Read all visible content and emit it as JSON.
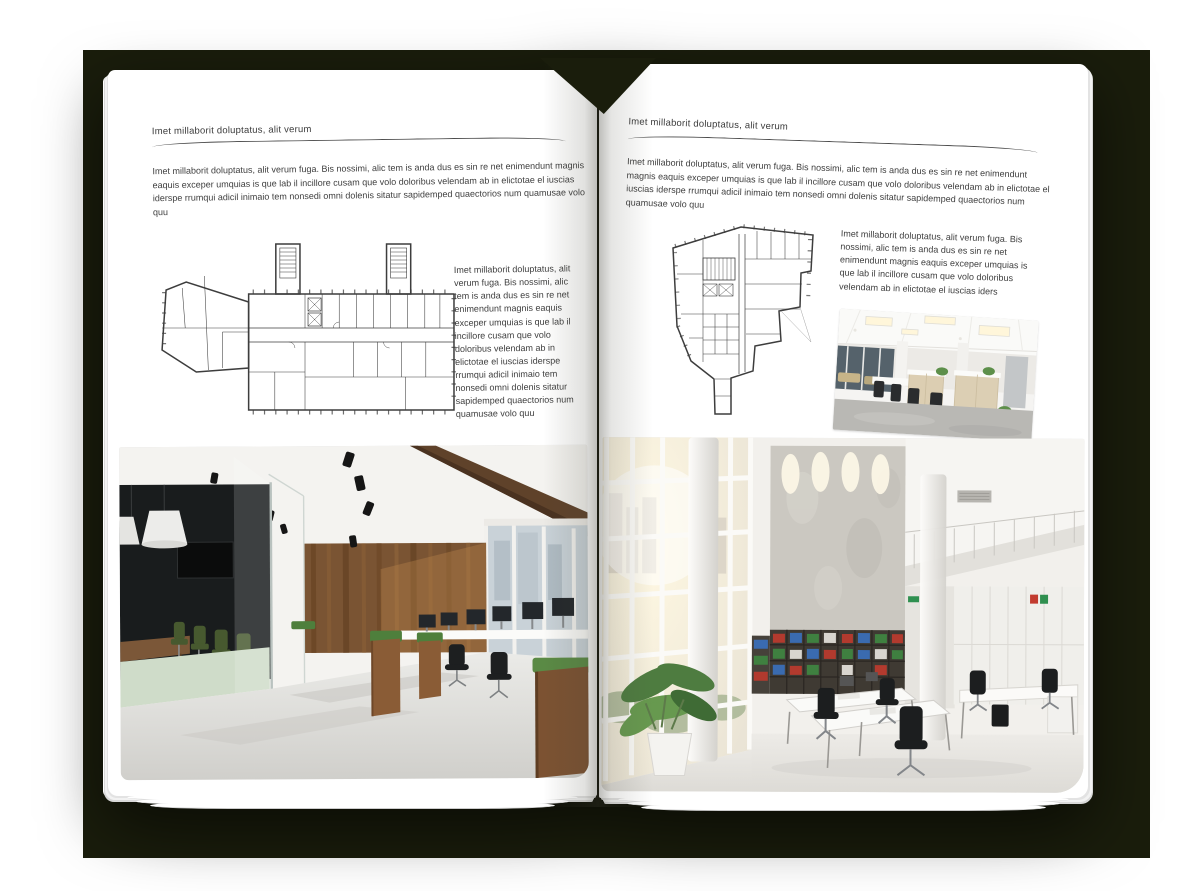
{
  "colors": {
    "backdrop": "#1a1d0c",
    "page": "#ffffff",
    "text": "#3e3e3e",
    "rule": "#4c4c4c",
    "plan_line": "#3d3d3d"
  },
  "left_page": {
    "header": "Imet millaborit doluptatus, alit verum",
    "body": "Imet millaborit doluptatus, alit verum fuga. Bis nossimi, alic tem is anda dus es sin re net enimendunt magnis eaquis exceper umquias is que lab il incillore cusam que volo doloribus velendam ab in elictotae el iuscias iderspe rrumqui adicil inimaio tem nonsedi omni dolenis sitatur sapidemped quaectorios num quamusae volo quu",
    "side_text": "Imet millaborit doluptatus, alit verum fuga. Bis nossimi, alic tem is anda dus es sin re net enimendunt magnis eaquis exceper umquias is que lab il incillore cusam que volo doloribus velendam ab in elictotae el iuscias iderspe rrumqui adicil inimaio tem nonsedi omni dolenis sitatur sapidemped quaectorios num quamusae volo quu"
  },
  "right_page": {
    "header": "Imet millaborit doluptatus, alit verum",
    "body": "Imet millaborit doluptatus, alit verum fuga. Bis nossimi, alic tem is anda dus es sin re net enimendunt magnis eaquis exceper umquias is que lab il incillore cusam que volo doloribus velendam ab in elictotae el iuscias iderspe rrumqui adicil inimaio tem nonsedi omni dolenis sitatur sapidemped quaectorios num quamusae volo quu",
    "side_text": "Imet millaborit doluptatus, alit verum fuga. Bis nossimi, alic tem is anda dus es sin re net enimendunt magnis eaquis exceper umquias is que lab il incillore cusam que volo doloribus velendam ab in elictotae el iuscias iders"
  }
}
